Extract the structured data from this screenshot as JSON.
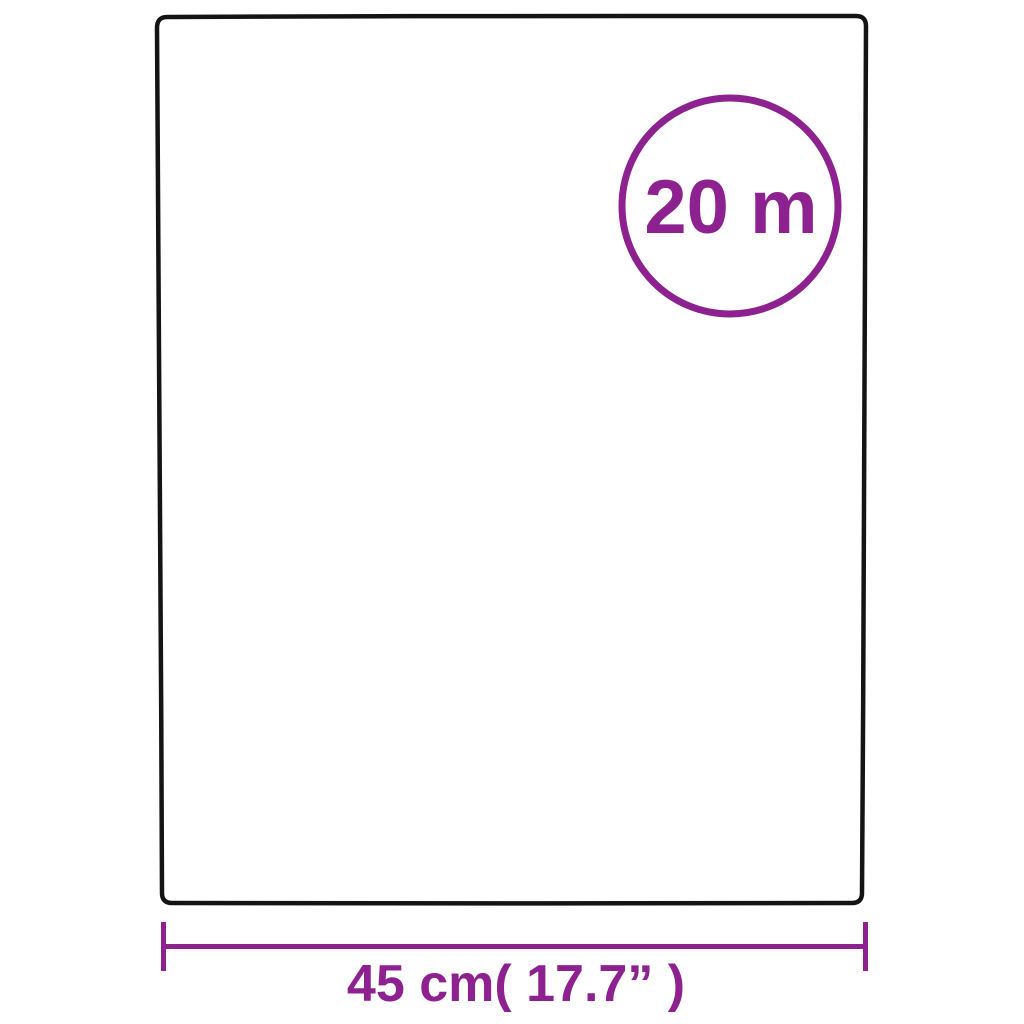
{
  "page": {
    "background": "#ffffff"
  },
  "colors": {
    "outline_black": "#141414",
    "accent_purple": "#8e2190"
  },
  "badge": {
    "label": "20 m"
  },
  "dimension": {
    "label": "45 cm( 17.7” )"
  }
}
